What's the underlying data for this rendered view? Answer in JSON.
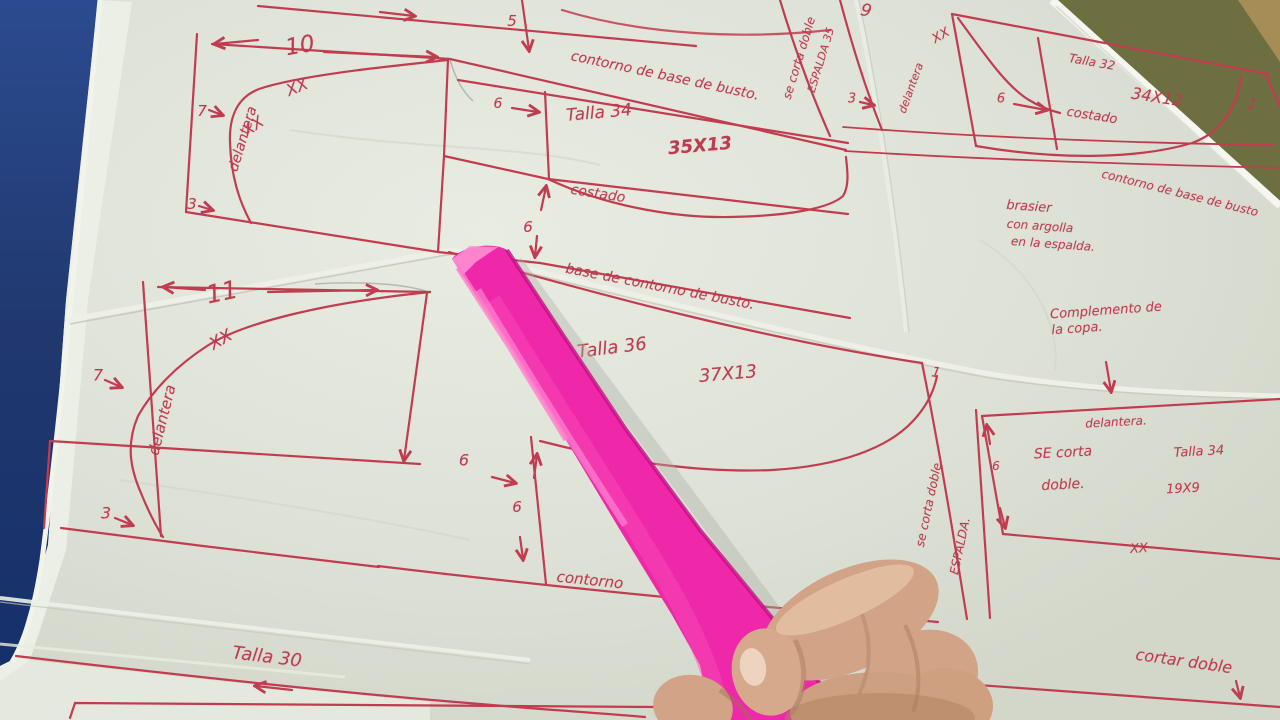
{
  "scene": {
    "description": "Hand-drawn bra sewing pattern sheets in red ink on pale tracing paper, a bright pink ruler held by a hand, on a blue table",
    "colors": {
      "paper": "#dde1d6",
      "ink": "#c23c50",
      "ruler_pink": "#ee28a8",
      "ruler_highlight": "#ff8ed4",
      "table_blue": "#23407e",
      "background_olive": "#6d6f41",
      "background_tan": "#ab8f58",
      "skin": "#d2a386"
    }
  },
  "labels": [
    {
      "name": "pattern10-number",
      "text": "10",
      "x": 300,
      "y": 46,
      "rot": -10,
      "fs": 23
    },
    {
      "name": "pattern10-xx-a",
      "text": "XX",
      "x": 297,
      "y": 87,
      "rot": -22,
      "fs": 16
    },
    {
      "name": "pattern10-xx-b",
      "text": "XX",
      "x": 253,
      "y": 126,
      "rot": -35,
      "fs": 16
    },
    {
      "name": "pattern10-delantera",
      "text": "delantera",
      "x": 243,
      "y": 139,
      "rot": -73,
      "fs": 14
    },
    {
      "name": "pattern10-measure-7",
      "text": "7",
      "x": 202,
      "y": 111,
      "rot": 0,
      "fs": 15
    },
    {
      "name": "pattern10-measure-3",
      "text": "3",
      "x": 192,
      "y": 204,
      "rot": 0,
      "fs": 15
    },
    {
      "name": "measure-5",
      "text": "5",
      "x": 512,
      "y": 21,
      "rot": 0,
      "fs": 15
    },
    {
      "name": "contorno-top",
      "text": "contorno de base de busto.",
      "x": 665,
      "y": 76,
      "rot": 12,
      "fs": 14
    },
    {
      "name": "espalda1-line1",
      "text": "se corta doble",
      "x": 799,
      "y": 58,
      "rot": -73,
      "fs": 12
    },
    {
      "name": "espalda1-line2",
      "text": "ESPALDA 35",
      "x": 821,
      "y": 60,
      "rot": -73,
      "fs": 11
    },
    {
      "name": "talla-34",
      "text": "Talla 34",
      "x": 599,
      "y": 113,
      "rot": -5,
      "fs": 17
    },
    {
      "name": "dim-35x13",
      "text": "35X13",
      "x": 700,
      "y": 146,
      "rot": -5,
      "fs": 18,
      "fw": "bold"
    },
    {
      "name": "costado-34",
      "text": "costado",
      "x": 598,
      "y": 194,
      "rot": 9,
      "fs": 14
    },
    {
      "name": "measure-6-c34",
      "text": "6",
      "x": 498,
      "y": 104,
      "rot": 0,
      "fs": 14
    },
    {
      "name": "measure-6-mid",
      "text": "6",
      "x": 528,
      "y": 227,
      "rot": 0,
      "fs": 15
    },
    {
      "name": "base-contorno",
      "text": "base de contorno de busto.",
      "x": 660,
      "y": 287,
      "rot": 11,
      "fs": 14
    },
    {
      "name": "pattern9-number",
      "text": "9",
      "x": 866,
      "y": 11,
      "rot": 12,
      "fs": 17
    },
    {
      "name": "pattern9-xx",
      "text": "XX",
      "x": 941,
      "y": 36,
      "rot": -30,
      "fs": 13
    },
    {
      "name": "pattern9-delantera",
      "text": "delantera",
      "x": 911,
      "y": 88,
      "rot": -70,
      "fs": 11
    },
    {
      "name": "pattern9-measure-3",
      "text": "3",
      "x": 852,
      "y": 99,
      "rot": 0,
      "fs": 13
    },
    {
      "name": "pattern9-measure-6",
      "text": "6",
      "x": 1001,
      "y": 99,
      "rot": 0,
      "fs": 13
    },
    {
      "name": "talla-32",
      "text": "Talla 32",
      "x": 1092,
      "y": 62,
      "rot": 10,
      "fs": 12
    },
    {
      "name": "dim-34x12",
      "text": "34X12",
      "x": 1157,
      "y": 97,
      "rot": 9,
      "fs": 16
    },
    {
      "name": "costado-32",
      "text": "costado",
      "x": 1092,
      "y": 116,
      "rot": 9,
      "fs": 13
    },
    {
      "name": "pattern9-measure-1",
      "text": "1",
      "x": 1252,
      "y": 104,
      "rot": 15,
      "fs": 15
    },
    {
      "name": "contorno-right",
      "text": "contorno de base de busto",
      "x": 1180,
      "y": 193,
      "rot": 14,
      "fs": 12
    },
    {
      "name": "brasier-note-1",
      "text": "brasier",
      "x": 1029,
      "y": 207,
      "rot": 4,
      "fs": 13
    },
    {
      "name": "brasier-note-2",
      "text": "con argolla",
      "x": 1040,
      "y": 226,
      "rot": 4,
      "fs": 12
    },
    {
      "name": "brasier-note-3",
      "text": "en la espalda.",
      "x": 1053,
      "y": 244,
      "rot": 4,
      "fs": 12
    },
    {
      "name": "complemento-1",
      "text": "Complemento de",
      "x": 1106,
      "y": 311,
      "rot": -4,
      "fs": 13
    },
    {
      "name": "complemento-2",
      "text": "la copa.",
      "x": 1077,
      "y": 329,
      "rot": -4,
      "fs": 13
    },
    {
      "name": "pattern11-number",
      "text": "11",
      "x": 222,
      "y": 292,
      "rot": -12,
      "fs": 25
    },
    {
      "name": "pattern11-xx",
      "text": "XX",
      "x": 221,
      "y": 340,
      "rot": -30,
      "fs": 17
    },
    {
      "name": "pattern11-delantera",
      "text": "delantera",
      "x": 162,
      "y": 420,
      "rot": -76,
      "fs": 15
    },
    {
      "name": "pattern11-measure-7",
      "text": "7",
      "x": 98,
      "y": 375,
      "rot": 0,
      "fs": 16
    },
    {
      "name": "pattern11-measure-3",
      "text": "3",
      "x": 106,
      "y": 513,
      "rot": 0,
      "fs": 16
    },
    {
      "name": "talla-36",
      "text": "Talla 36",
      "x": 612,
      "y": 348,
      "rot": -7,
      "fs": 18
    },
    {
      "name": "dim-37x13",
      "text": "37X13",
      "x": 728,
      "y": 374,
      "rot": -5,
      "fs": 18
    },
    {
      "name": "measure-6-a",
      "text": "6",
      "x": 464,
      "y": 460,
      "rot": 0,
      "fs": 16
    },
    {
      "name": "measure-6-b",
      "text": "6",
      "x": 517,
      "y": 507,
      "rot": 0,
      "fs": 15
    },
    {
      "name": "contorno-36",
      "text": "contorno",
      "x": 590,
      "y": 580,
      "rot": 6,
      "fs": 15
    },
    {
      "name": "pattern36-measure-1",
      "text": "1",
      "x": 936,
      "y": 373,
      "rot": 10,
      "fs": 14
    },
    {
      "name": "espalda2-line1",
      "text": "se corta doble.",
      "x": 929,
      "y": 503,
      "rot": -78,
      "fs": 12
    },
    {
      "name": "espalda2-line2",
      "text": "ESPALDA.",
      "x": 960,
      "y": 546,
      "rot": -78,
      "fs": 12
    },
    {
      "name": "rect-delantera",
      "text": "delantera.",
      "x": 1116,
      "y": 422,
      "rot": -3,
      "fs": 12
    },
    {
      "name": "rect-se-corta",
      "text": "SE corta",
      "x": 1063,
      "y": 453,
      "rot": -3,
      "fs": 14
    },
    {
      "name": "rect-doble",
      "text": "doble.",
      "x": 1063,
      "y": 485,
      "rot": -3,
      "fs": 14
    },
    {
      "name": "rect-talla-34",
      "text": "Talla 34",
      "x": 1199,
      "y": 452,
      "rot": -3,
      "fs": 13
    },
    {
      "name": "rect-dim-19x9",
      "text": "19X9",
      "x": 1183,
      "y": 489,
      "rot": -3,
      "fs": 13
    },
    {
      "name": "rect-measure-6",
      "text": "6",
      "x": 996,
      "y": 466,
      "rot": 0,
      "fs": 12
    },
    {
      "name": "rect-xx",
      "text": "XX",
      "x": 1139,
      "y": 549,
      "rot": -3,
      "fs": 13
    },
    {
      "name": "talla-30",
      "text": "Talla 30",
      "x": 267,
      "y": 657,
      "rot": 7,
      "fs": 18
    },
    {
      "name": "upside-down-35",
      "text": "35",
      "x": 684,
      "y": 700,
      "rot": 185,
      "fs": 14
    },
    {
      "name": "cortar-doble",
      "text": "cortar doble",
      "x": 1184,
      "y": 661,
      "rot": 8,
      "fs": 16
    }
  ]
}
